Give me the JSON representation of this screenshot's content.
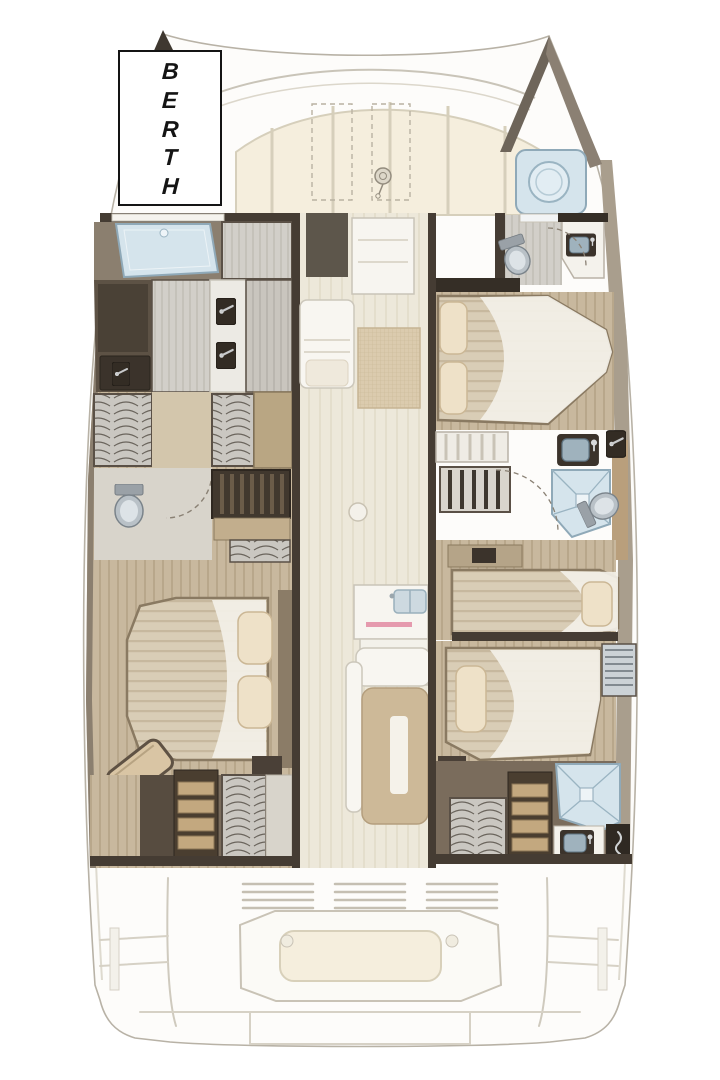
{
  "page": {
    "background": "#ffffff"
  },
  "berth_label": {
    "text": "BERTH"
  },
  "colors": {
    "wall-dark": "#453c33",
    "wall-deep": "#352e26",
    "hull-band": "#8b7f6f",
    "hull-band-right": "#a99e8d",
    "wood-trim": "#b99f7c",
    "wood-floor": "#c8b89e",
    "corridor": "#ece7d9",
    "panel-light": "#d2cfc9",
    "locker": "#cac7c1",
    "locker-line": "#6a645c",
    "mattress": "#d9cdb6",
    "mattress-stripe": "#c7b89e",
    "sheet": "#f3f0e8",
    "pillow": "#eee1c8",
    "pillow-line": "#cbb795",
    "water-fixture": "#d5e4ec",
    "water-line": "#8fa9b8",
    "toilet-body": "#b9c1c7",
    "toilet-seat": "#dde3e7",
    "deck-faded": "#f8f6f1",
    "deck-line": "#c9c3b6",
    "cushion": "#f5eedd",
    "cushion-line": "#d8d0ba",
    "table": "#cdb998",
    "step-tread": "#c3a87f",
    "step-frame": "#4a3e30",
    "accent-pink": "#e59aae",
    "hull-outline": "#b8b2a6"
  },
  "icons": [
    "berth-hatch-icon",
    "toilet-icon",
    "sink-icon",
    "shower-icon",
    "galley-sink-icon",
    "windlass-icon",
    "steps-icon",
    "hanging-locker-icon",
    "double-bed-icon",
    "single-bed-icon",
    "door-swing-arc",
    "cockpit-bench-icon",
    "handle-icon",
    "bow-tip-icon"
  ]
}
